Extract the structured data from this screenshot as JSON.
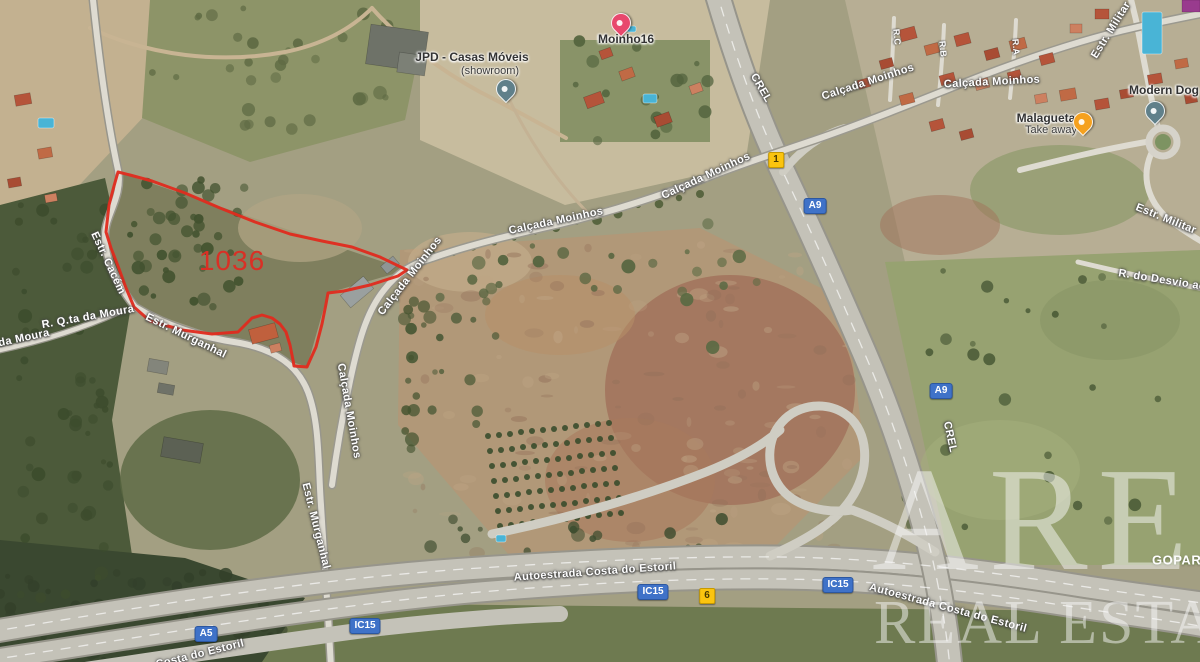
{
  "map": {
    "parcel": {
      "number": "1036",
      "outline_color": "#e02b1e",
      "outline_points": "118,172 130,175 152,181 185,193 220,208 255,222 290,234 322,241 352,247 380,257 407,270 398,276 370,285 344,291 328,293 326,304 322,324 316,347 311,358 307,367 294,366 293,360 290,345 286,332 280,324 272,318 262,315 252,318 238,332 212,334 182,330 150,321 134,307 126,288 118,266 111,248 106,232 109,205 114,186"
    },
    "labels": [
      {
        "name": "label-jpd-casas-moveis",
        "kind": "poi",
        "text": "JPD - Casas Móveis",
        "x": 472,
        "y": 57,
        "rot": 0
      },
      {
        "name": "label-jpd-showroom",
        "kind": "poi-sub",
        "text": "(showroom)",
        "x": 490,
        "y": 71,
        "rot": 0
      },
      {
        "name": "label-moinho16",
        "kind": "poi",
        "text": "Moinho16",
        "x": 626,
        "y": 39,
        "rot": 0
      },
      {
        "name": "label-modern-dog",
        "kind": "poi",
        "text": "Modern Dog",
        "x": 1164,
        "y": 90,
        "rot": 0
      },
      {
        "name": "label-malagueta",
        "kind": "poi",
        "text": "Malagueta",
        "x": 1046,
        "y": 118,
        "rot": 0
      },
      {
        "name": "label-malagueta-take-away",
        "kind": "poi-sub",
        "text": "Take away",
        "x": 1051,
        "y": 130,
        "rot": 0
      },
      {
        "name": "label-crel-top",
        "kind": "road",
        "text": "CREL",
        "x": 761,
        "y": 88,
        "rot": 60
      },
      {
        "name": "label-crel-right",
        "kind": "road",
        "text": "CREL",
        "x": 950,
        "y": 437,
        "rot": 78
      },
      {
        "name": "label-calcada-moinhos-bridge",
        "kind": "road",
        "text": "Calçada Moinhos",
        "x": 706,
        "y": 176,
        "rot": -25
      },
      {
        "name": "label-calcada-moinhos-upper-right",
        "kind": "road",
        "text": "Calçada Moinhos",
        "x": 868,
        "y": 82,
        "rot": -18
      },
      {
        "name": "label-calcada-moinhos-right-horiz",
        "kind": "road",
        "text": "Calçada Moinhos",
        "x": 992,
        "y": 82,
        "rot": -3
      },
      {
        "name": "label-calcada-moinhos-mid",
        "kind": "road",
        "text": "Calçada Moinhos",
        "x": 556,
        "y": 221,
        "rot": -12
      },
      {
        "name": "label-calcada-moinhos-diag",
        "kind": "road",
        "text": "Calçada Moinhos",
        "x": 410,
        "y": 276,
        "rot": -52
      },
      {
        "name": "label-calcada-moinhos-vertical",
        "kind": "road",
        "text": "Calçada Moinhos",
        "x": 349,
        "y": 411,
        "rot": 80
      },
      {
        "name": "label-estr-cacem",
        "kind": "road",
        "text": "Estr. Cacém",
        "x": 108,
        "y": 263,
        "rot": 65
      },
      {
        "name": "label-r-qta-da-moura",
        "kind": "road",
        "text": "R. Q.ta da Moura",
        "x": 88,
        "y": 317,
        "rot": -10
      },
      {
        "name": "label-da-moura",
        "kind": "road",
        "text": "da Moura",
        "x": 24,
        "y": 338,
        "rot": -12
      },
      {
        "name": "label-estr-murganhal-upper",
        "kind": "road",
        "text": "Estr. Murganhal",
        "x": 186,
        "y": 336,
        "rot": 26
      },
      {
        "name": "label-estr-murganhal-lower",
        "kind": "road",
        "text": "Estr. Murganhal",
        "x": 316,
        "y": 526,
        "rot": 76
      },
      {
        "name": "label-estr-militar-top",
        "kind": "road",
        "text": "Estr. Militar",
        "x": 1111,
        "y": 30,
        "rot": -58
      },
      {
        "name": "label-estr-militar-right",
        "kind": "road",
        "text": "Estr. Militar",
        "x": 1166,
        "y": 219,
        "rot": 22
      },
      {
        "name": "label-r-do-desvio",
        "kind": "road",
        "text": "R. do Desvio ao C",
        "x": 1168,
        "y": 281,
        "rot": 9
      },
      {
        "name": "label-rc",
        "kind": "road-sm",
        "text": "R.C",
        "x": 897,
        "y": 37,
        "rot": 85
      },
      {
        "name": "label-rb",
        "kind": "road-sm",
        "text": "R.B",
        "x": 943,
        "y": 49,
        "rot": 85
      },
      {
        "name": "label-ra",
        "kind": "road-sm",
        "text": "R.A",
        "x": 1016,
        "y": 47,
        "rot": 85
      },
      {
        "name": "label-autoestrada-center",
        "kind": "road",
        "text": "Autoestrada Costa do Estoril",
        "x": 595,
        "y": 572,
        "rot": -4
      },
      {
        "name": "label-autoestrada-right",
        "kind": "road",
        "text": "Autoestrada Costa do Estoril",
        "x": 948,
        "y": 608,
        "rot": 15
      },
      {
        "name": "label-costa-do-estoril-partial",
        "kind": "road",
        "text": "Costa do Estoril",
        "x": 200,
        "y": 654,
        "rot": -14
      },
      {
        "name": "label-goparty",
        "kind": "overlay-white",
        "text": "GOPARTY",
        "x": 1152,
        "y": 560,
        "rot": 0
      },
      {
        "name": "label-parcel-number",
        "kind": "parcel-num",
        "text": "1036",
        "x": 232,
        "y": 261,
        "rot": 0
      }
    ],
    "shields": [
      {
        "name": "shield-n1",
        "type": "yellow",
        "text": "1",
        "x": 776,
        "y": 160
      },
      {
        "name": "shield-a9-upper",
        "type": "blue",
        "text": "A9",
        "x": 815,
        "y": 206
      },
      {
        "name": "shield-a9-lower",
        "type": "blue",
        "text": "A9",
        "x": 941,
        "y": 391
      },
      {
        "name": "shield-ic15-center",
        "type": "blue",
        "text": "IC15",
        "x": 653,
        "y": 592
      },
      {
        "name": "shield-n6",
        "type": "yellow",
        "text": "6",
        "x": 707,
        "y": 596
      },
      {
        "name": "shield-ic15-right",
        "type": "blue",
        "text": "IC15",
        "x": 838,
        "y": 585
      },
      {
        "name": "shield-ic15-left",
        "type": "blue",
        "text": "IC15",
        "x": 365,
        "y": 626
      },
      {
        "name": "shield-a5",
        "type": "blue",
        "text": "A5",
        "x": 206,
        "y": 634
      }
    ],
    "pins": [
      {
        "name": "pin-moinho16",
        "color": "#e8486d",
        "tip_x": 620,
        "tip_y": 34
      },
      {
        "name": "pin-jpd-showroom",
        "color": "#60808a",
        "tip_x": 505,
        "tip_y": 100
      },
      {
        "name": "pin-modern-dog",
        "color": "#60808a",
        "tip_x": 1154,
        "tip_y": 122
      },
      {
        "name": "pin-malagueta",
        "color": "#f5a11f",
        "tip_x": 1082,
        "tip_y": 133
      }
    ],
    "watermark": {
      "line1": "ARE",
      "line2": "REAL ESTATE"
    }
  }
}
